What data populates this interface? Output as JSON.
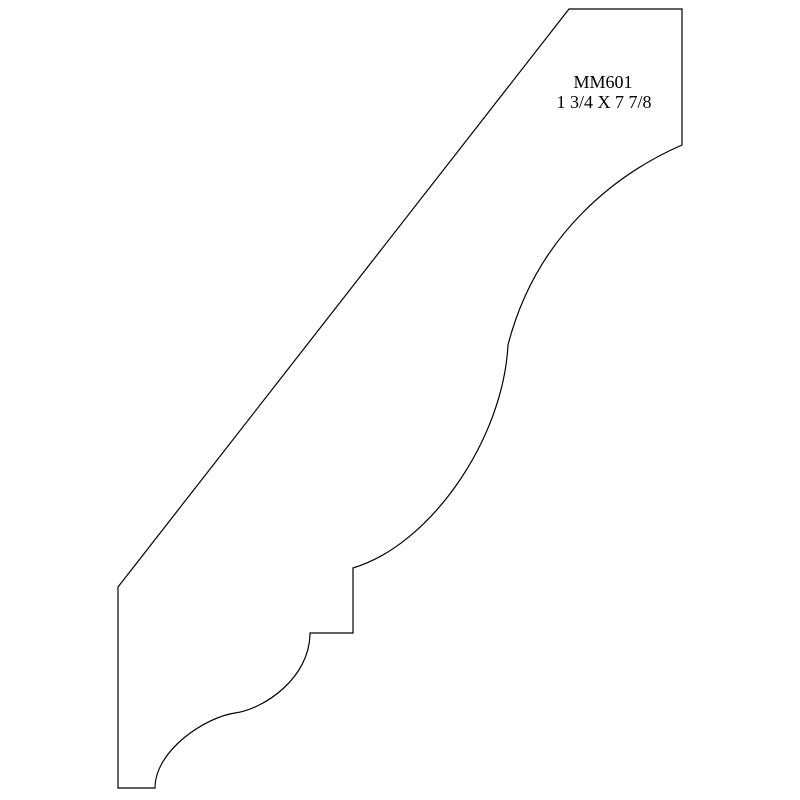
{
  "page": {
    "background_color": "#ffffff"
  },
  "diagram": {
    "type": "molding-profile-drawing",
    "part_number": "MM601",
    "dimensions": "1 3/4 X 7 7/8",
    "line_color": "#000000",
    "outline_path": "M 569 9 L 682 9 L 682 145 C 620 172 537 232 508 345 C 503 440 430 545 353 568 L 353 633 L 310 633 C 310 678 264 709 235 713 C 206 717 155 750 155 788 L 118 788 L 118 587 Z"
  }
}
